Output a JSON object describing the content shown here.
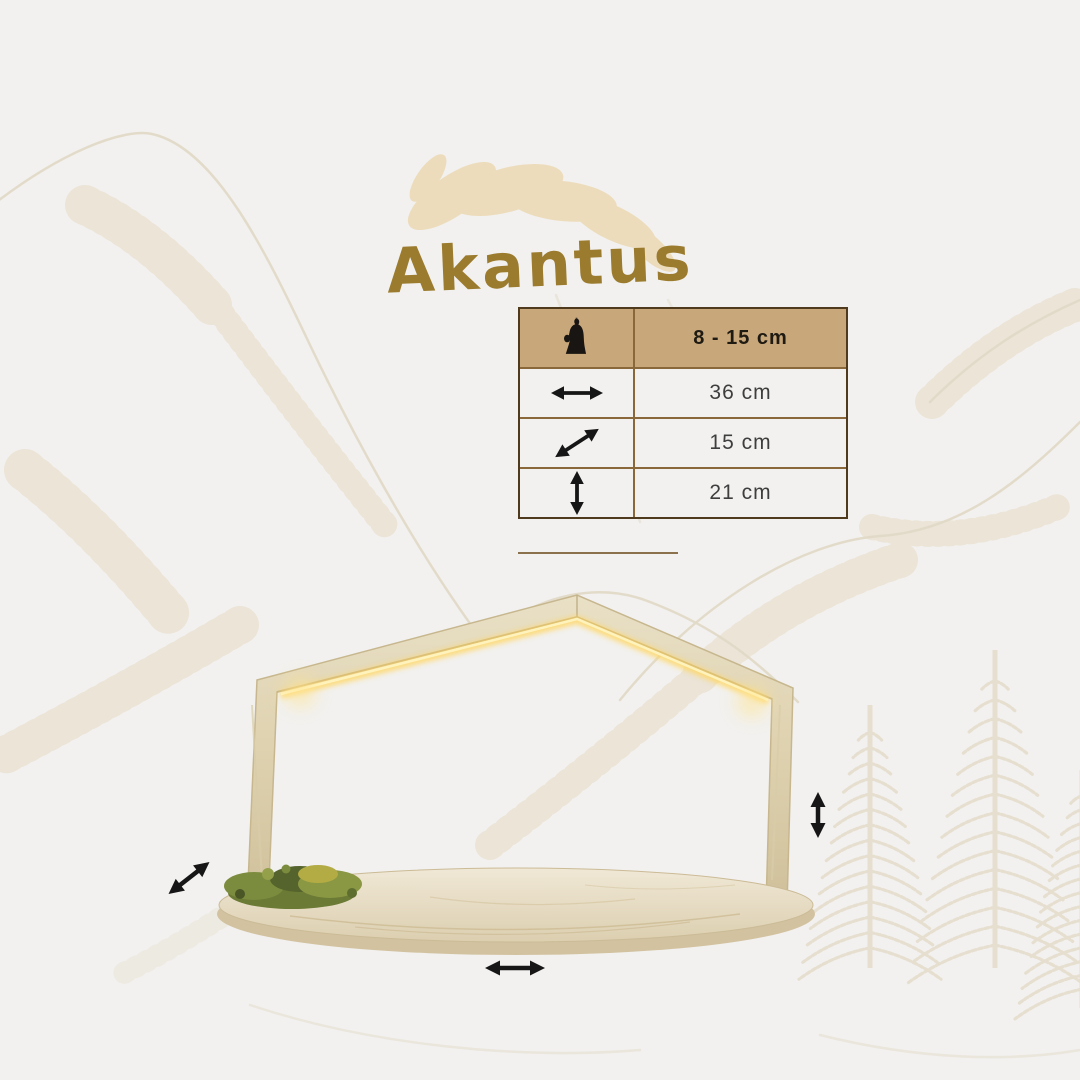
{
  "title": {
    "text": "Akantus"
  },
  "colors": {
    "background": "#f2f1ef",
    "accent_gold": "#9b7b2e",
    "leaf_decoration": "#ecd9b2",
    "sketch_beige": "#e6dfd0",
    "table_header_bg": "#c8a87b",
    "table_border_outer": "#4f3a1e",
    "table_border_inner": "#8a683a",
    "arrow_black": "#161616",
    "wood_light": "#e8dfc4",
    "wood_dark": "#d2c2a0",
    "led_glow": "#ffd661",
    "moss_green": "#6b7a35"
  },
  "size_table": {
    "header": {
      "icon": "nativity-figure-icon",
      "label": "8 - 15 cm"
    },
    "rows": [
      {
        "icon": "horizontal-arrow-icon",
        "dimension": "width",
        "label": "36 cm"
      },
      {
        "icon": "diagonal-arrow-icon",
        "dimension": "depth",
        "label": "15 cm"
      },
      {
        "icon": "vertical-arrow-icon",
        "dimension": "height",
        "label": "21 cm"
      }
    ]
  },
  "product": {
    "kind": "wooden-house-shaped-candle-arch-with-led-and-moss",
    "measurement_arrows": [
      {
        "icon": "diagonal-arrow-icon",
        "position": "left-of-base"
      },
      {
        "icon": "vertical-arrow-icon",
        "position": "right-of-frame"
      },
      {
        "icon": "horizontal-arrow-icon",
        "position": "below-base"
      }
    ]
  },
  "background_decorations": [
    "mountain-sketch",
    "pine-trees-sketch",
    "acanthus-leaf"
  ]
}
